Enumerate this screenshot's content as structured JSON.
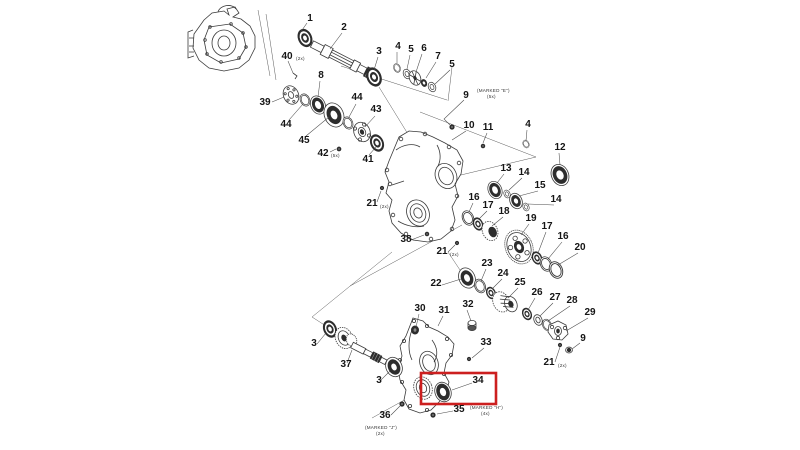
{
  "figure": {
    "kind": "exploded-parts-diagram",
    "highlighted_part": "34",
    "colors": {
      "background": "#ffffff",
      "line": "#3a3a3a",
      "highlight_box": "#cc1f1f"
    }
  },
  "callouts": [
    {
      "text": "1"
    },
    {
      "text": "2"
    },
    {
      "text": "40"
    },
    {
      "text": "3"
    },
    {
      "text": "4"
    },
    {
      "text": "5"
    },
    {
      "text": "6"
    },
    {
      "text": "7"
    },
    {
      "text": "5"
    },
    {
      "text": "8"
    },
    {
      "text": "39"
    },
    {
      "text": "44"
    },
    {
      "text": "45"
    },
    {
      "text": "42"
    },
    {
      "text": "44"
    },
    {
      "text": "43"
    },
    {
      "text": "41"
    },
    {
      "text": "9"
    },
    {
      "text": "10"
    },
    {
      "text": "11"
    },
    {
      "text": "4"
    },
    {
      "text": "12"
    },
    {
      "text": "13"
    },
    {
      "text": "14"
    },
    {
      "text": "15"
    },
    {
      "text": "14"
    },
    {
      "text": "16"
    },
    {
      "text": "17"
    },
    {
      "text": "18"
    },
    {
      "text": "19"
    },
    {
      "text": "17"
    },
    {
      "text": "16"
    },
    {
      "text": "20"
    },
    {
      "text": "38"
    },
    {
      "text": "21"
    },
    {
      "text": "21"
    },
    {
      "text": "22"
    },
    {
      "text": "23"
    },
    {
      "text": "24"
    },
    {
      "text": "25"
    },
    {
      "text": "26"
    },
    {
      "text": "27"
    },
    {
      "text": "28"
    },
    {
      "text": "29"
    },
    {
      "text": "9"
    },
    {
      "text": "21"
    },
    {
      "text": "30"
    },
    {
      "text": "31"
    },
    {
      "text": "32"
    },
    {
      "text": "33"
    },
    {
      "text": "34"
    },
    {
      "text": "35"
    },
    {
      "text": "36"
    },
    {
      "text": "37"
    },
    {
      "text": "3"
    },
    {
      "text": "3"
    }
  ],
  "annotations": [
    {
      "text": "(2x)"
    },
    {
      "text": "(5x)"
    },
    {
      "text": "(MARKED \"E\")"
    },
    {
      "text": "(5x)"
    },
    {
      "text": "(2x)"
    },
    {
      "text": "(2x)"
    },
    {
      "text": "(2x)"
    },
    {
      "text": "(MARKED \"H\")"
    },
    {
      "text": "(4x)"
    },
    {
      "text": "(MARKED \"J\")"
    },
    {
      "text": "(2x)"
    }
  ]
}
